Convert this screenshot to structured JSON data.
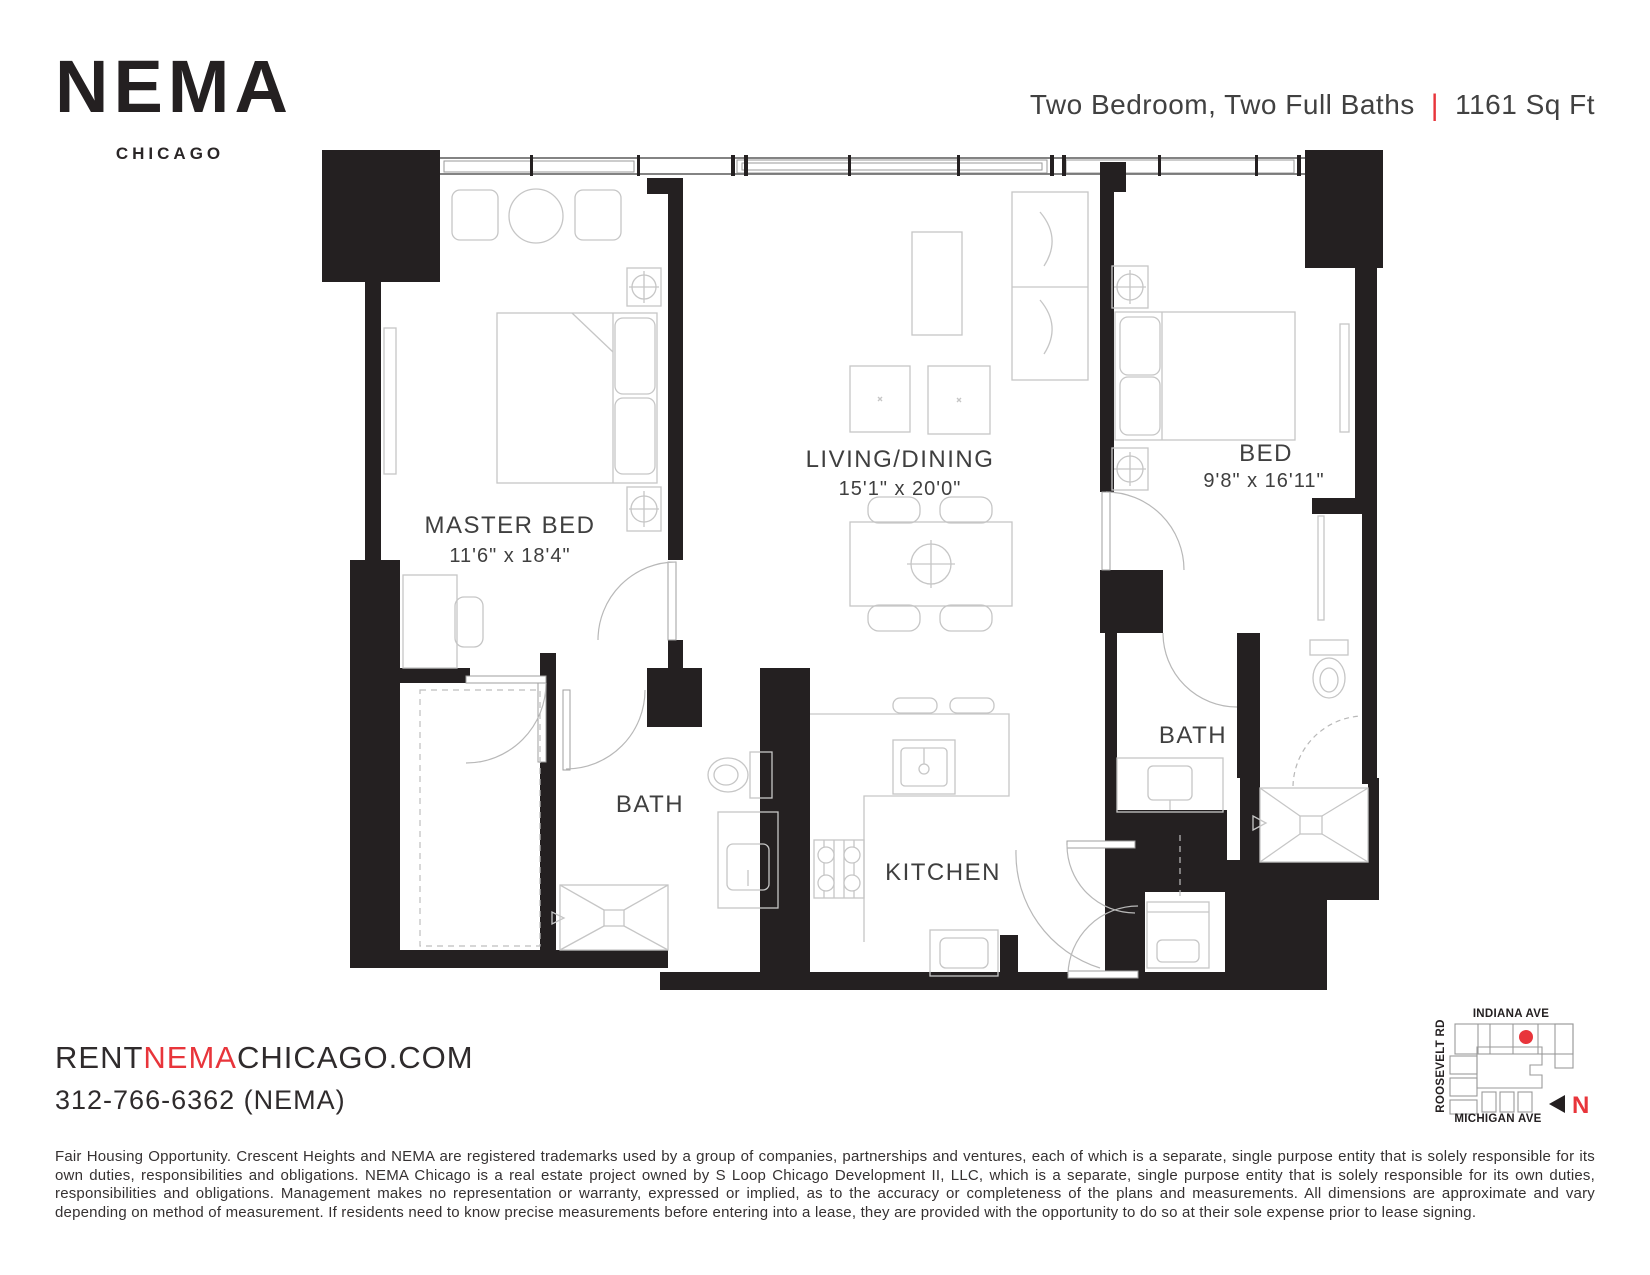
{
  "brand": {
    "name": "NEMA",
    "city": "CHICAGO"
  },
  "header": {
    "unit_type": "Two Bedroom, Two Full Baths",
    "separator": "|",
    "area": "1161 Sq Ft"
  },
  "floorplan": {
    "master_bed": {
      "name": "MASTER BED",
      "dims": "11'6\" x 18'4\""
    },
    "living_dining": {
      "name": "LIVING/DINING",
      "dims": "15'1\" x 20'0\""
    },
    "bed2": {
      "name": "BED",
      "dims": "9'8\" x 16'11\""
    },
    "bath1": {
      "name": "BATH"
    },
    "bath2": {
      "name": "BATH"
    },
    "kitchen": {
      "name": "KITCHEN"
    }
  },
  "map": {
    "street_top": "INDIANA AVE",
    "street_left": "ROOSEVELT RD",
    "street_bottom": "MICHIGAN AVE",
    "north_label": "N",
    "marker_color": "#e8353b"
  },
  "contact": {
    "website_prefix": "RENT",
    "website_brand": "NEMA",
    "website_suffix": "CHICAGO.COM",
    "phone": "312-766-6362 (NEMA)"
  },
  "disclaimer": "Fair Housing Opportunity. Crescent Heights and NEMA are registered trademarks used by a group of companies, partnerships and ventures, each of which is a separate, single purpose entity that is solely responsible for its own duties, responsibilities and obligations. NEMA Chicago is a real estate project owned by S Loop Chicago Development II, LLC, which is a separate, single purpose entity that is solely responsible for its own duties, responsibilities and obligations. Management makes no representation or warranty, expressed or implied, as to the accuracy or completeness of the plans and measurements. All dimensions are approximate and vary depending on method of measurement. If residents need to know precise measurements before entering into a lease, they are provided with the opportunity to do so at their sole expense prior to lease signing.",
  "colors": {
    "accent": "#e8353b",
    "wall": "#242021",
    "ink": "#3f3f3f"
  }
}
